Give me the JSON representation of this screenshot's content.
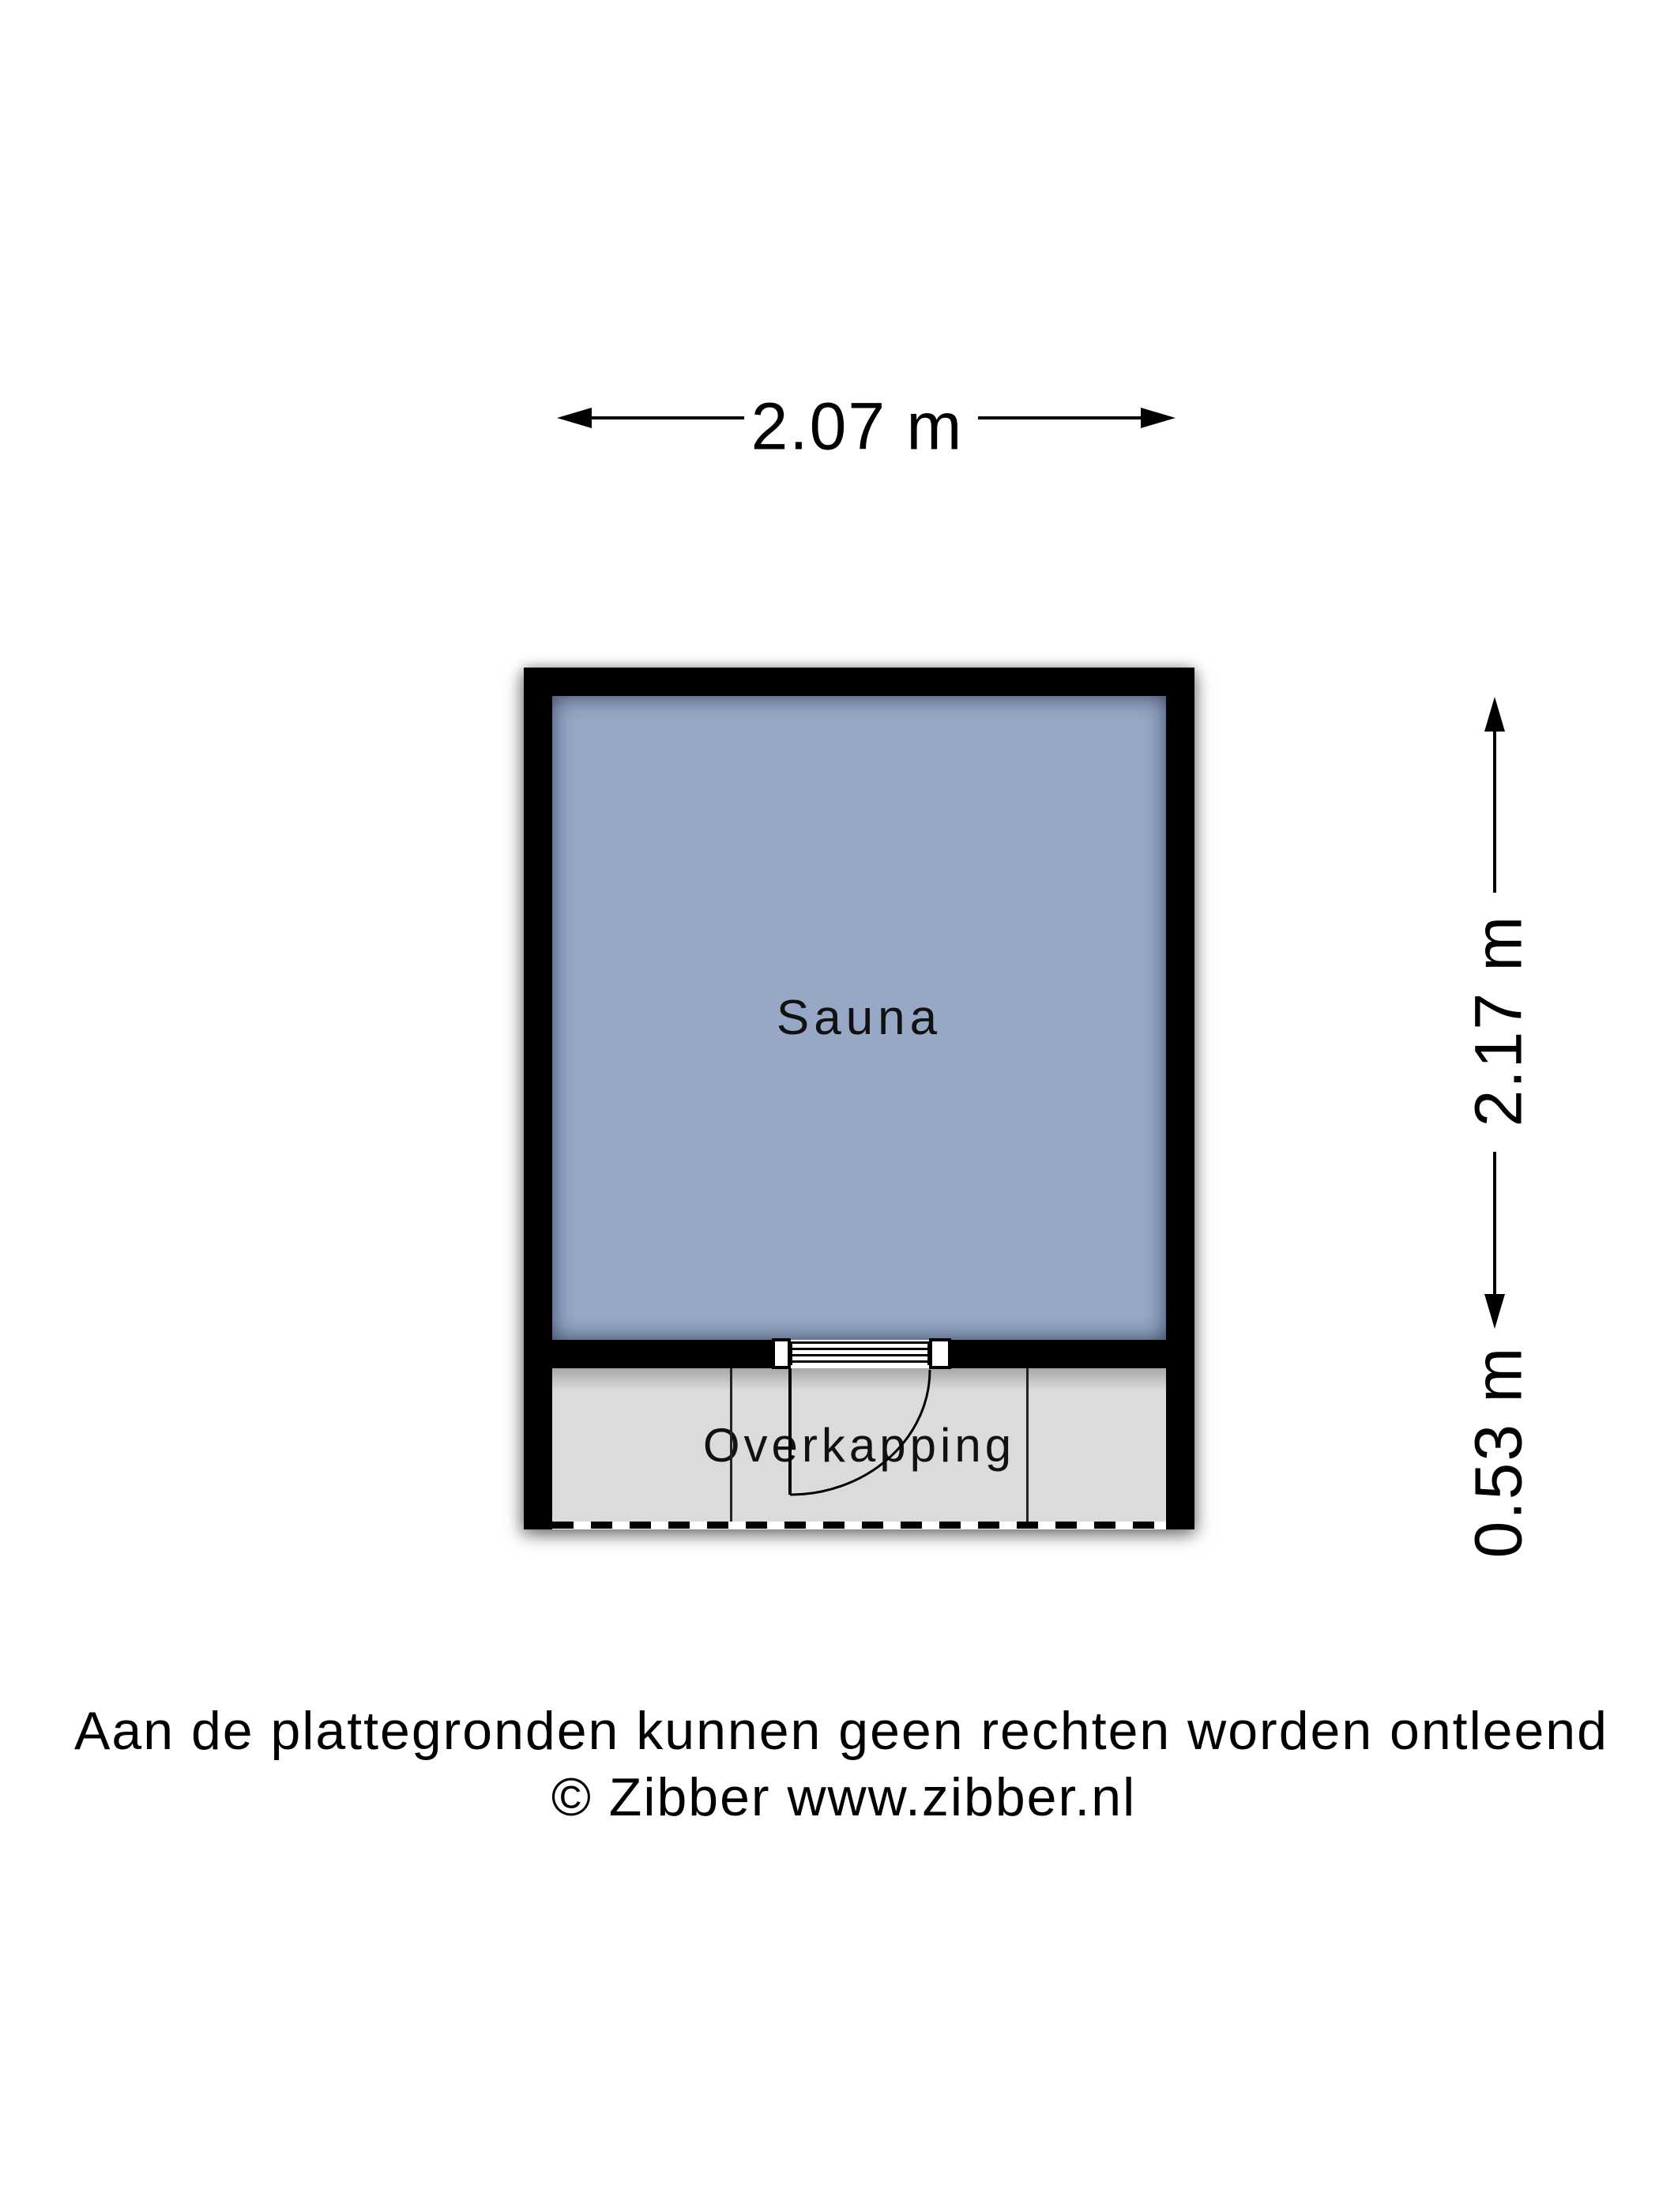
{
  "plan": {
    "title": "Plattegrond sauna",
    "rooms": [
      {
        "label": "Sauna",
        "fill": "#96A8C6"
      },
      {
        "label": "Overkapping",
        "fill": "#DBDBDB"
      }
    ],
    "dimensions": {
      "width_label": "2.07 m",
      "height_label": "2.17 m",
      "overhang_depth_label": "0.53 m"
    },
    "colors": {
      "wall": "#000000",
      "sauna_fill": "#96A8C6",
      "overhang_fill": "#DBDBDB",
      "background": "#ffffff",
      "line": "#000000"
    }
  },
  "footer": {
    "disclaimer": "Aan de plattegronden kunnen geen rechten worden ontleend",
    "copyright": "© Zibber www.zibber.nl"
  }
}
